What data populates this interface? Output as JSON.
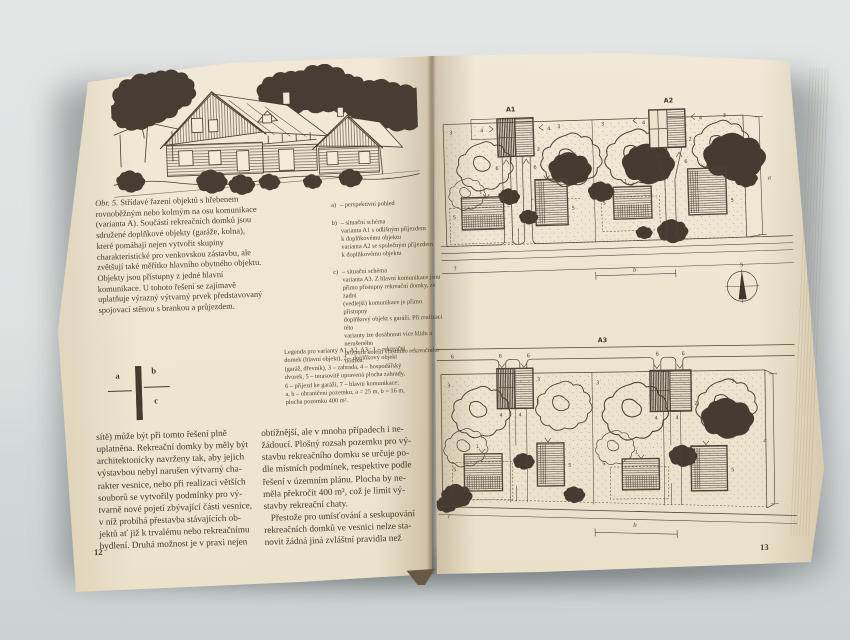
{
  "colors": {
    "backdrop": "#dce0df",
    "paper": "#efe6d1",
    "ink": "#453b30",
    "plan_ink": "#4c443a"
  },
  "book": {
    "left_page": {
      "caption": {
        "label": "Obr. 5.",
        "text": " Střídavé řazení objektů s hřebenem\nrovnoběžným nebo kolmým na osu komunikace\n(varianta A). Součástí rekreačních domků jsou\nsdružené doplňkové objekty (garáže, kolna),\nkteré pomáhají nejen vytvořit skupiny\ncharakteristické pro venkovskou zástavbu, ale\nzvětšují také měřítko hlavního obytného objektu.\nObjekty jsou přístupny z jedné hlavní\nkomunikace. U tohoto řešení se zajímavě\nuplatňuje výrazný výtvarný prvek představovaný\nspojovací stěnou s brankou a průjezdem."
      },
      "list": [
        {
          "marker": "a)",
          "text": "– perspektivní pohled"
        },
        {
          "marker": "b)",
          "text": "– situační schéma\nvarianta A1 s odlišným příjezdem\nk doplňkovému objektu\nvarianta A2 se společným příjezdem\nk doplňkovému objektu"
        },
        {
          "marker": "c)",
          "text": "– situační schéma\nvarianta A3. Z hlavní komunikace jsou\npřímo přístupny rekreační domky, ze zadní\n(vedlejší) komunikace je přímo přístupný\ndoplňkový objekt s garáží. Při realizaci této\nvarianty lze dosáhnout více klidu a nerušeného\nprostoru kolem vlastního rekreačního domku."
        }
      ],
      "legend": "Legenda pro varianty A1, A2, A3 : 1 – rekreační\ndomek (hlavní objekt), 2 – doplňkový objekt\n(garáž, dřevník), 3 – zahrada, 4 – hospodářský\ndvorek, 5 – terasovitě upravená plocha zahrady,\n6 – příjezd ke garáži, 7 – hlavní komunikace;\na, b – ohraničení pozemku, a = 25 m, b = 16 m,\nplocha pozemku 400 m².",
      "figure_key": {
        "a": "a",
        "b": "b",
        "c": "c"
      },
      "body_col1": "sítě) může být při tomto řešení plně\nuplatněna. Rekreační domky by měly být\narchitektonicky navrženy tak, aby jejich\nvýstavbou nebyl narušen výtvarný cha-\nrakter vesnice, nebo při realizaci větších\nsouborů se vytvořily podmínky pro vý-\ntvarně nové pojetí zbývající části vesnice,\nv níž probíhá přestavba stávajících ob-\njektů ať již k trvalému nebo rekreačnímu\nbydlení. Druhá možnost je v praxi nejen",
      "body_col2": "obtížnější, ale v mnoha případech i ne-\nžádoucí. Plošný rozsah pozemku pro vý-\nstavbu rekreačního domku se určuje po-\ndle místních podmínek, respektive podle\nřešení v územním plánu. Plocha by ne-\nměla překročit 400 m², což je limit vý-\nstavby rekreační chaty.\n   Přestože pro umísťování a seskupování\nrekreačních domků ve vesnici nelze sta-\nnovit žádná jiná zvláštní pravidla než",
      "page_number": "12"
    },
    "right_page": {
      "plans": {
        "a1": "A1",
        "a2": "A2",
        "a3": "A3"
      },
      "compass_north": "S",
      "numbers": {
        "house": "1",
        "annex": "2",
        "garden": "3",
        "yard": "4",
        "terrace": "5",
        "driveway": "6",
        "road": "7"
      },
      "dims": {
        "a": "a",
        "b": "b"
      },
      "page_number": "13"
    }
  }
}
